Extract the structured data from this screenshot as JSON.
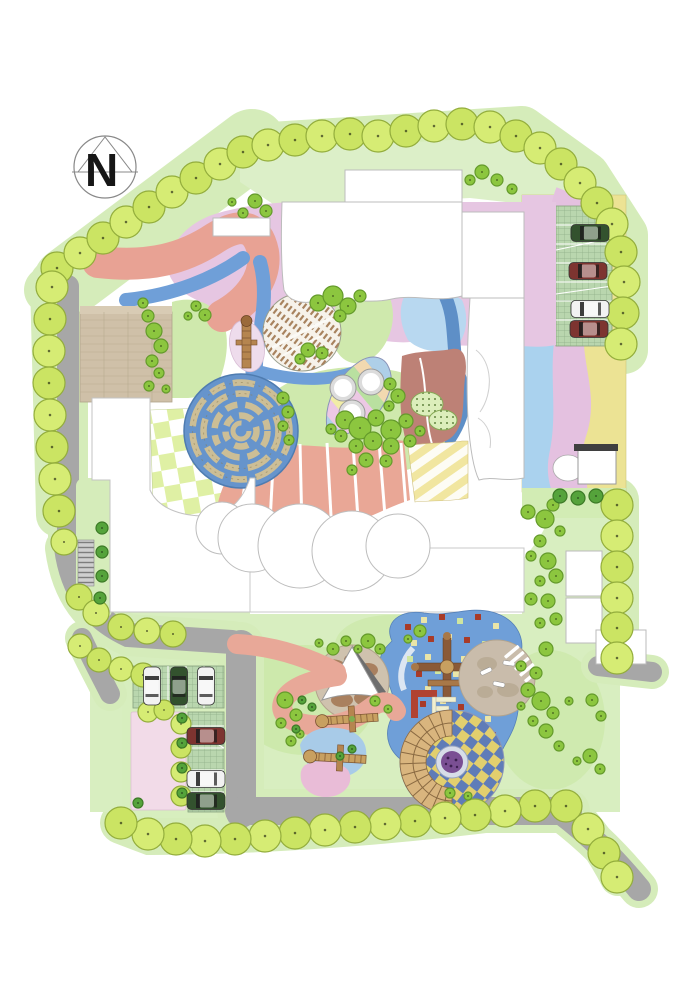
{
  "compass": {
    "label": "N"
  },
  "palette": {
    "perimeter_tree": "#d6ec74",
    "perimeter_tree_alt": "#cbe463",
    "perimeter_tree_stroke": "#93ad3c",
    "scatter_tree": "#8cc63f",
    "scatter_tree_stroke": "#649a2b",
    "dark_tree": "#55a33b",
    "dark_tree_stroke": "#3c7a26",
    "road": "#a7a7a7",
    "verge": "#d5ecba",
    "water_blue": "#6f9fd8",
    "light_blue": "#aad2ee",
    "plum": "#e6c6e2",
    "salmon": "#e8a294",
    "fan_salmon": "#e9a796",
    "lawn": "#cfe9ad",
    "field": "#d8eec0",
    "band": "#dcefc8",
    "yellow": "#ece394",
    "tan": "#cfc0a8",
    "brown_zone": "#bd8176",
    "maze_blue": "#6694cc",
    "maze_hedge": "#ccbe96",
    "checker_green": "#dff0a4",
    "plaza_checker_yellow": "#e2cf6e",
    "plaza_checker_blue": "#5f7cb8",
    "purple_center": "#7a4f93",
    "car_white": "#f2f2f2",
    "car_green": "#33522e",
    "car_red": "#7d3430",
    "confetti_red": "#a83b28",
    "confetti_yellow": "#eae5a8",
    "confetti_green": "#cfe6a0"
  },
  "trees": {
    "perimeter": [
      [
        57,
        268
      ],
      [
        80,
        253
      ],
      [
        103,
        238
      ],
      [
        126,
        222
      ],
      [
        149,
        207
      ],
      [
        172,
        192
      ],
      [
        196,
        178
      ],
      [
        220,
        164
      ],
      [
        243,
        152
      ],
      [
        268,
        145
      ],
      [
        295,
        140
      ],
      [
        322,
        136
      ],
      [
        350,
        134
      ],
      [
        378,
        136
      ],
      [
        406,
        131
      ],
      [
        434,
        126
      ],
      [
        462,
        124
      ],
      [
        490,
        127
      ],
      [
        516,
        136
      ],
      [
        540,
        148
      ],
      [
        561,
        164
      ],
      [
        580,
        183
      ],
      [
        597,
        203
      ],
      [
        612,
        224
      ],
      [
        621,
        252
      ],
      [
        624,
        282
      ],
      [
        623,
        313
      ],
      [
        621,
        344
      ],
      [
        617,
        505
      ],
      [
        617,
        536
      ],
      [
        617,
        567
      ],
      [
        617,
        598
      ],
      [
        617,
        628
      ],
      [
        617,
        658
      ],
      [
        566,
        806
      ],
      [
        588,
        829
      ],
      [
        604,
        853
      ],
      [
        617,
        877
      ],
      [
        535,
        806
      ],
      [
        505,
        811
      ],
      [
        475,
        815
      ],
      [
        445,
        818
      ],
      [
        415,
        821
      ],
      [
        385,
        824
      ],
      [
        355,
        827
      ],
      [
        325,
        830
      ],
      [
        295,
        833
      ],
      [
        265,
        836
      ],
      [
        235,
        839
      ],
      [
        205,
        841
      ],
      [
        176,
        839
      ],
      [
        148,
        834
      ],
      [
        121,
        823
      ],
      [
        52,
        287
      ],
      [
        50,
        319
      ],
      [
        49,
        351
      ],
      [
        49,
        383
      ],
      [
        50,
        415
      ],
      [
        52,
        447
      ],
      [
        55,
        479
      ],
      [
        59,
        511
      ],
      [
        64,
        542,
        13
      ],
      [
        79,
        597,
        13
      ],
      [
        96,
        613,
        13
      ],
      [
        121,
        627,
        13
      ],
      [
        147,
        631,
        13
      ],
      [
        173,
        634,
        13
      ],
      [
        80,
        646,
        12
      ],
      [
        99,
        660,
        12
      ],
      [
        121,
        669,
        12
      ],
      [
        143,
        675,
        12
      ],
      [
        148,
        712,
        10
      ],
      [
        164,
        710,
        10
      ],
      [
        181,
        724,
        10
      ],
      [
        181,
        748,
        10
      ],
      [
        181,
        772,
        10
      ],
      [
        181,
        796,
        10
      ]
    ],
    "scatter": [
      [
        318,
        303,
        8
      ],
      [
        333,
        296,
        10
      ],
      [
        348,
        306,
        8
      ],
      [
        360,
        296,
        6
      ],
      [
        340,
        316,
        6
      ],
      [
        308,
        350,
        7
      ],
      [
        322,
        353,
        6
      ],
      [
        300,
        359,
        5
      ],
      [
        283,
        398,
        6
      ],
      [
        288,
        412,
        6
      ],
      [
        283,
        426,
        5
      ],
      [
        289,
        440,
        5
      ],
      [
        148,
        316,
        6
      ],
      [
        154,
        331,
        8
      ],
      [
        161,
        346,
        7
      ],
      [
        152,
        361,
        6
      ],
      [
        159,
        373,
        5
      ],
      [
        149,
        386,
        5
      ],
      [
        166,
        389,
        4
      ],
      [
        143,
        303,
        5
      ],
      [
        196,
        306,
        5
      ],
      [
        205,
        315,
        6
      ],
      [
        188,
        316,
        4
      ],
      [
        255,
        201,
        7
      ],
      [
        266,
        211,
        6
      ],
      [
        243,
        213,
        5
      ],
      [
        232,
        202,
        4
      ],
      [
        482,
        172,
        7
      ],
      [
        497,
        180,
        6
      ],
      [
        470,
        180,
        5
      ],
      [
        512,
        189,
        5
      ],
      [
        390,
        384,
        6
      ],
      [
        398,
        396,
        7
      ],
      [
        389,
        406,
        5
      ],
      [
        345,
        420,
        9
      ],
      [
        360,
        428,
        11
      ],
      [
        376,
        418,
        8
      ],
      [
        391,
        430,
        10
      ],
      [
        406,
        421,
        7
      ],
      [
        373,
        441,
        9
      ],
      [
        356,
        446,
        7
      ],
      [
        391,
        446,
        8
      ],
      [
        410,
        441,
        6
      ],
      [
        420,
        431,
        5
      ],
      [
        341,
        436,
        6
      ],
      [
        366,
        460,
        7
      ],
      [
        386,
        461,
        6
      ],
      [
        352,
        470,
        5
      ],
      [
        331,
        429,
        5
      ],
      [
        528,
        512,
        7
      ],
      [
        545,
        519,
        9
      ],
      [
        553,
        505,
        6
      ],
      [
        560,
        531,
        5
      ],
      [
        540,
        541,
        6
      ],
      [
        531,
        556,
        5
      ],
      [
        548,
        561,
        8
      ],
      [
        556,
        576,
        7
      ],
      [
        540,
        581,
        5
      ],
      [
        531,
        599,
        6
      ],
      [
        548,
        601,
        7
      ],
      [
        556,
        619,
        6
      ],
      [
        540,
        623,
        5
      ],
      [
        546,
        649,
        7
      ],
      [
        521,
        666,
        5
      ],
      [
        536,
        673,
        6
      ],
      [
        285,
        700,
        8
      ],
      [
        296,
        715,
        6
      ],
      [
        281,
        723,
        5
      ],
      [
        300,
        734,
        4
      ],
      [
        291,
        741,
        5
      ],
      [
        368,
        641,
        7
      ],
      [
        380,
        649,
        5
      ],
      [
        358,
        649,
        4
      ],
      [
        420,
        631,
        6
      ],
      [
        408,
        639,
        4
      ],
      [
        528,
        690,
        7
      ],
      [
        541,
        701,
        9
      ],
      [
        553,
        713,
        6
      ],
      [
        533,
        721,
        5
      ],
      [
        546,
        731,
        7
      ],
      [
        559,
        746,
        5
      ],
      [
        569,
        701,
        4
      ],
      [
        521,
        706,
        4
      ],
      [
        592,
        700,
        6
      ],
      [
        601,
        716,
        5
      ],
      [
        590,
        756,
        7
      ],
      [
        600,
        769,
        5
      ],
      [
        577,
        761,
        4
      ],
      [
        450,
        793,
        5
      ],
      [
        468,
        796,
        4
      ],
      [
        375,
        701,
        5
      ],
      [
        388,
        709,
        4
      ],
      [
        333,
        649,
        6
      ],
      [
        346,
        641,
        5
      ],
      [
        319,
        643,
        4
      ]
    ],
    "dark": [
      [
        560,
        496,
        7
      ],
      [
        578,
        498,
        7
      ],
      [
        596,
        496,
        7
      ],
      [
        102,
        528,
        6
      ],
      [
        102,
        552,
        6
      ],
      [
        102,
        576,
        6
      ],
      [
        100,
        598,
        6
      ],
      [
        182,
        718,
        5
      ],
      [
        182,
        743,
        5
      ],
      [
        182,
        768,
        5
      ],
      [
        182,
        793,
        5
      ],
      [
        138,
        803,
        5
      ],
      [
        302,
        700,
        4
      ],
      [
        312,
        707,
        4
      ],
      [
        296,
        729,
        4
      ],
      [
        340,
        756,
        4
      ],
      [
        352,
        749,
        4
      ]
    ]
  },
  "cars": [
    {
      "x": 590,
      "y": 233,
      "dir": "h",
      "color": "green"
    },
    {
      "x": 588,
      "y": 271,
      "dir": "h",
      "color": "red"
    },
    {
      "x": 590,
      "y": 309,
      "dir": "h",
      "color": "white"
    },
    {
      "x": 589,
      "y": 329,
      "dir": "h",
      "color": "red"
    },
    {
      "x": 152,
      "y": 686,
      "dir": "v",
      "color": "white"
    },
    {
      "x": 179,
      "y": 686,
      "dir": "v",
      "color": "green"
    },
    {
      "x": 206,
      "y": 686,
      "dir": "v",
      "color": "white"
    },
    {
      "x": 206,
      "y": 736,
      "dir": "h",
      "color": "red"
    },
    {
      "x": 206,
      "y": 779,
      "dir": "h",
      "color": "white"
    },
    {
      "x": 206,
      "y": 801,
      "dir": "h",
      "color": "green"
    }
  ],
  "confetti": [
    [
      408,
      627,
      "r"
    ],
    [
      424,
      620,
      "y"
    ],
    [
      442,
      617,
      "r"
    ],
    [
      460,
      621,
      "g"
    ],
    [
      478,
      617,
      "r"
    ],
    [
      496,
      626,
      "y"
    ],
    [
      414,
      643,
      "y"
    ],
    [
      431,
      639,
      "r"
    ],
    [
      449,
      637,
      "y"
    ],
    [
      467,
      640,
      "r"
    ],
    [
      485,
      644,
      "g"
    ],
    [
      410,
      659,
      "g"
    ],
    [
      428,
      657,
      "y"
    ],
    [
      446,
      654,
      "r"
    ],
    [
      464,
      659,
      "y"
    ],
    [
      482,
      661,
      "r"
    ],
    [
      419,
      674,
      "r"
    ],
    [
      438,
      671,
      "g"
    ],
    [
      456,
      674,
      "y"
    ],
    [
      474,
      677,
      "r"
    ],
    [
      428,
      689,
      "y"
    ],
    [
      447,
      687,
      "r"
    ],
    [
      465,
      691,
      "g"
    ],
    [
      423,
      704,
      "r"
    ],
    [
      443,
      701,
      "y"
    ],
    [
      461,
      707,
      "r"
    ],
    [
      479,
      704,
      "y"
    ],
    [
      433,
      719,
      "g"
    ],
    [
      453,
      717,
      "r"
    ],
    [
      471,
      721,
      "y"
    ],
    [
      439,
      734,
      "r"
    ],
    [
      459,
      731,
      "g"
    ],
    [
      477,
      737,
      "r"
    ],
    [
      488,
      719,
      "y"
    ],
    [
      493,
      735,
      "r"
    ]
  ],
  "ladders": [
    [
      352,
      719,
      -4
    ],
    [
      340,
      758,
      3
    ]
  ]
}
